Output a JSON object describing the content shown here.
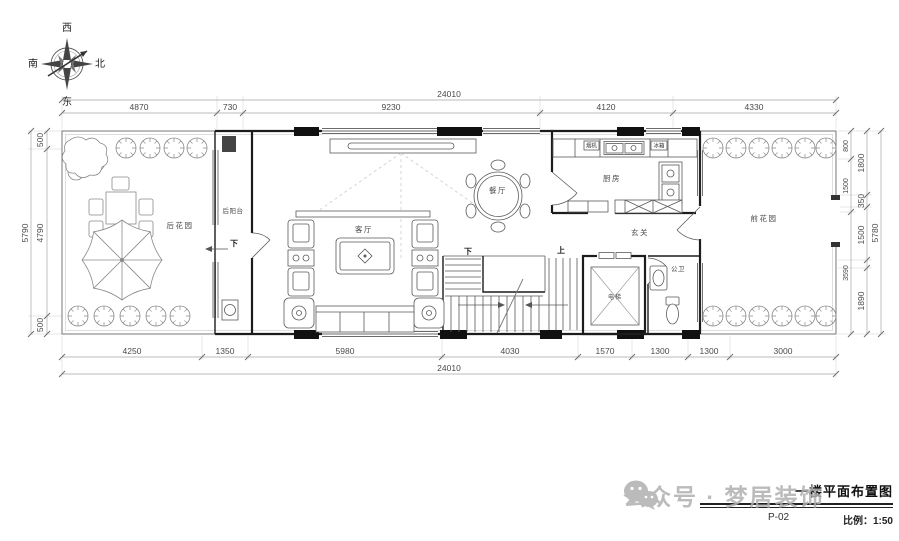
{
  "compass": {
    "west": "西",
    "north": "北",
    "east": "东",
    "south": "南"
  },
  "dims": {
    "top": {
      "total": "24010",
      "segments": [
        "4870",
        "730",
        "9230",
        "4120",
        "4330"
      ]
    },
    "bottom": {
      "total": "24010",
      "segments": [
        "4250",
        "1350",
        "5980",
        "4030",
        "1570",
        "1300",
        "1300",
        "3000"
      ]
    },
    "left": {
      "total": "5790",
      "segments": [
        "500",
        "4790",
        "500"
      ]
    },
    "right": {
      "total": "5780",
      "inner": [
        "800",
        "1500",
        "3590"
      ],
      "outer": [
        "1800",
        "350",
        "1500",
        "1890"
      ]
    }
  },
  "rooms": {
    "back_garden": "后花园",
    "back_balcony": "后阳台",
    "living": "客厅",
    "dining": "餐厅",
    "kitchen": "厨房",
    "entry": "玄关",
    "bath": "公卫",
    "elevator": "电梯",
    "front_garden": "前花园"
  },
  "plan_labels": {
    "balcony_down": "下",
    "stair_down": "下",
    "stair_up": "上",
    "hood": "烟机",
    "fridge": "冰箱"
  },
  "title_block": {
    "title": "一楼平面布置图",
    "sheet": "P-02",
    "scale": "比例：1:50"
  },
  "watermark": {
    "text": "公众号 · 梦居装饰"
  }
}
